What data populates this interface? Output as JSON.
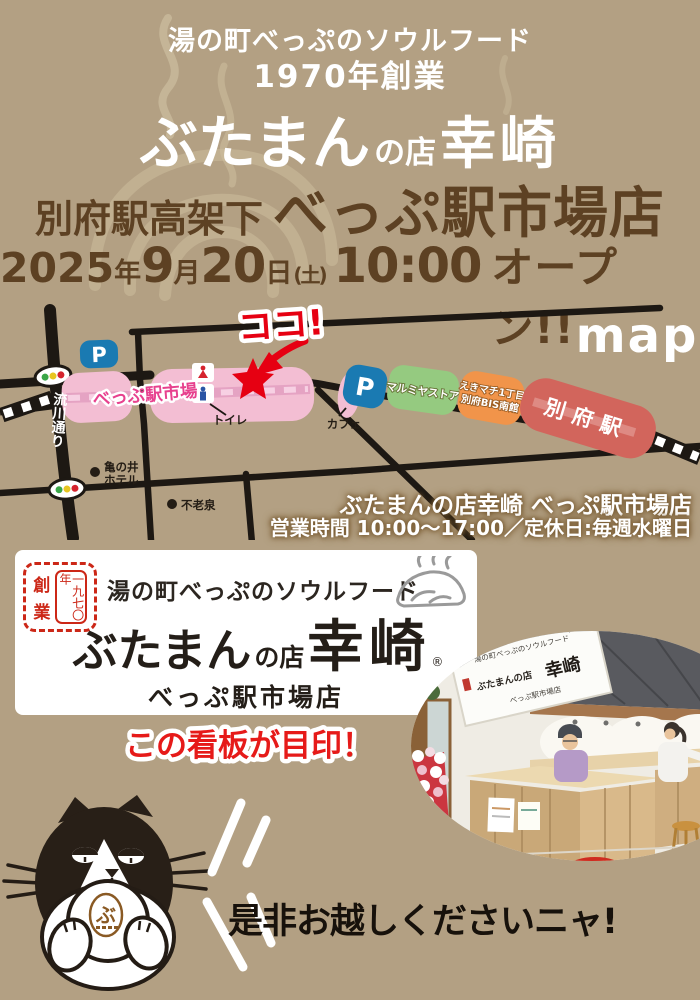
{
  "header": {
    "tagline": "湯の町べっぷのソウルフード",
    "established": "1970年創業",
    "brand": {
      "main": "ぶたまん",
      "mid": "の店",
      "name": "幸崎"
    },
    "subtitle": {
      "location": "別府駅高架下",
      "store": "べっぷ駅市場店"
    },
    "opening": {
      "year": "2025",
      "year_unit": "年",
      "month": "9",
      "month_unit": "月",
      "day": "20",
      "day_unit": "日",
      "weekday": "(土)",
      "time": "10:00",
      "label": "オープン!!"
    }
  },
  "map": {
    "corner_label": "map",
    "here": "ココ!",
    "market": "べっぷ駅市場",
    "street": "流川通り",
    "toilet": "トイレ",
    "cafe": "カフェ",
    "parking": "P",
    "hotel_line1": "亀の井",
    "hotel_line2": "ホテル",
    "spring": "不老泉",
    "marumiya": "マルミヤストア",
    "ekimachi_line1": "えきマチ1丁目",
    "ekimachi_line2": "別府BIS南館",
    "station": "別府駅",
    "info_line1": "ぶたまんの店幸崎 べっぷ駅市場店",
    "info_line2": "営業時間 10:00〜17:00／定休日:毎週水曜日"
  },
  "signboard": {
    "seal": {
      "char_top": "創",
      "char_bottom": "業",
      "col_right": "一九七〇年"
    },
    "tagline": "湯の町べっぷのソウルフード",
    "brand": {
      "main": "ぶたまん",
      "mid": "の店",
      "name": "幸崎",
      "registered": "®"
    },
    "store": "べっぷ駅市場店",
    "caption": "この看板が目印！"
  },
  "photo": {
    "sign_line1": "湯の町べっぷのソウルフード",
    "sign_brand_left": "ぶたまんの店",
    "sign_brand_name": "幸崎",
    "sign_line3": "べっぷ駅市場店"
  },
  "footer": {
    "message": "是非お越しくださいニャ!",
    "stamp": "ぶ"
  },
  "colors": {
    "background": "#b3a083",
    "title_brown": "#5d4123",
    "accent_red": "#e60012",
    "map_pink": "#f3bed3",
    "market_text": "#e7418e",
    "parking_blue": "#1a7ab2",
    "marumiya_green": "#95ca80",
    "ekimachi_orange": "#f1944a",
    "station_red": "#d2655c",
    "seal_red": "#cc2717",
    "caption_red": "#e61a19"
  }
}
